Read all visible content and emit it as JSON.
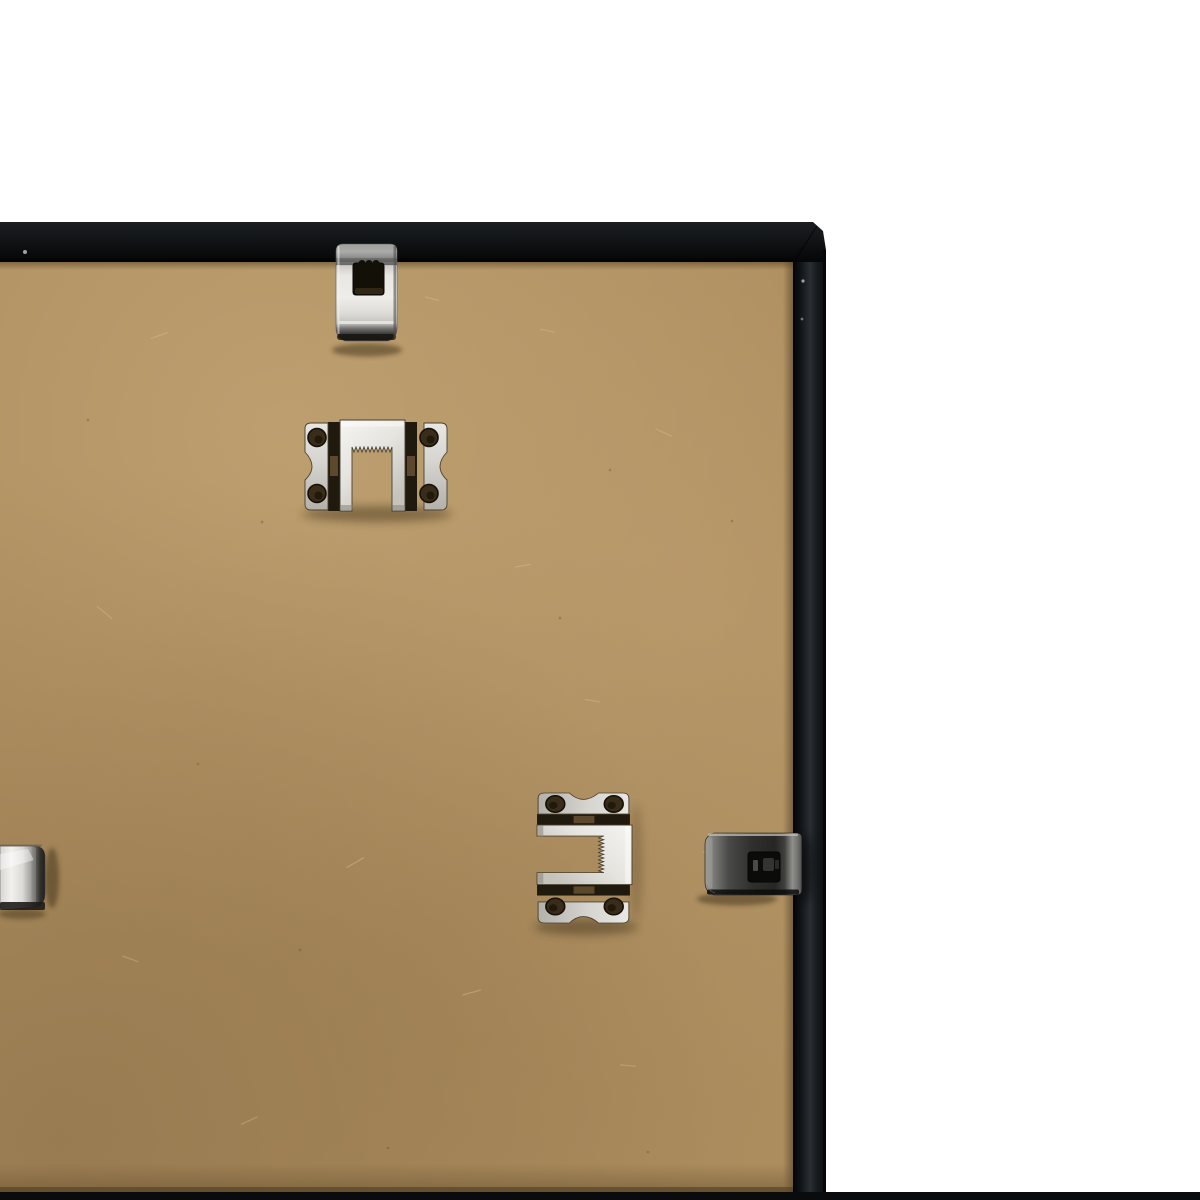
{
  "scene": {
    "type": "product-photo",
    "description": "Close-up of the top-right back corner of a black picture frame: tan MDF backing board, black metal frame rails, silver sawtooth hangers and spring clips, white background, thin black crop bar along the bottom edge",
    "background_color": "#ffffff",
    "bottom_crop_bar_color": "#090b0c"
  },
  "frame": {
    "label": "black picture frame, back view",
    "rail_color": "#101315",
    "rail_highlight": "#2a2f34",
    "top_rail_label": "top frame rail",
    "right_rail_label": "right frame rail"
  },
  "board": {
    "label": "MDF backing board",
    "base_color": "#ae8f60",
    "light_tone": "#c9ab7c",
    "dark_tone": "#7f6440"
  },
  "hardware": {
    "metal_color": "#e9e7e3",
    "dark_metal_color": "#2e2e2d",
    "items": [
      {
        "id": "spring-clip-top",
        "label": "silver spring clip on top rail"
      },
      {
        "id": "sawtooth-hanger-top",
        "label": "sawtooth hanger, horizontal"
      },
      {
        "id": "sawtooth-hanger-bottom",
        "label": "sawtooth hanger, vertical"
      },
      {
        "id": "flexi-clip-right",
        "label": "dark spring clip on right rail"
      },
      {
        "id": "flexi-clip-left",
        "label": "silver spring clip, cropped at left edge"
      }
    ]
  }
}
